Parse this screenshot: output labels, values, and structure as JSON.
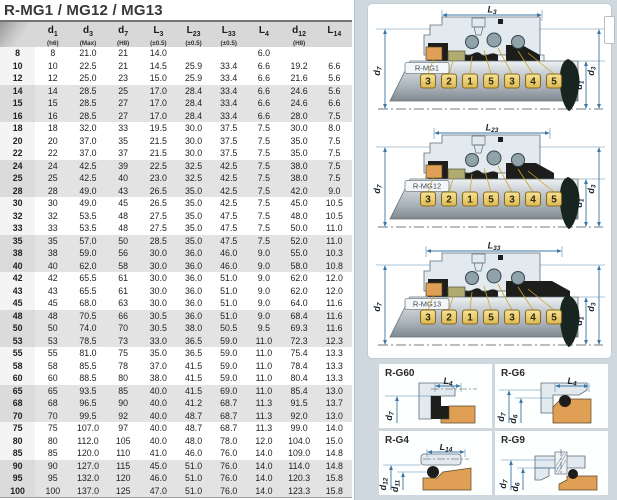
{
  "title": "R-MG1 / MG12 / MG13",
  "table": {
    "headers": [
      {
        "main": "",
        "sub": "",
        "note": ""
      },
      {
        "main": "d",
        "sub": "1",
        "note": "(h6)"
      },
      {
        "main": "d",
        "sub": "3",
        "note": "(Max)"
      },
      {
        "main": "d",
        "sub": "7",
        "note": "(H8)"
      },
      {
        "main": "L",
        "sub": "3",
        "note": "(±0.5)"
      },
      {
        "main": "L",
        "sub": "23",
        "note": "(±0.5)"
      },
      {
        "main": "L",
        "sub": "33",
        "note": "(±0.5)"
      },
      {
        "main": "L",
        "sub": "4",
        "note": ""
      },
      {
        "main": "d",
        "sub": "12",
        "note": "(H8)"
      },
      {
        "main": "L",
        "sub": "14",
        "note": ""
      }
    ],
    "rows": [
      [
        "8",
        "8",
        "21.0",
        "21",
        "14.0",
        "",
        "",
        "6.0",
        "",
        ""
      ],
      [
        "10",
        "10",
        "22.5",
        "21",
        "14.5",
        "25.9",
        "33.4",
        "6.6",
        "19.2",
        "6.6"
      ],
      [
        "12",
        "12",
        "25.0",
        "23",
        "15.0",
        "25.9",
        "33.4",
        "6.6",
        "21.6",
        "5.6"
      ],
      [
        "14",
        "14",
        "28.5",
        "25",
        "17.0",
        "28.4",
        "33.4",
        "6.6",
        "24.6",
        "5.6"
      ],
      [
        "15",
        "15",
        "28.5",
        "27",
        "17.0",
        "28.4",
        "33.4",
        "6.6",
        "24.6",
        "6.6"
      ],
      [
        "16",
        "16",
        "28.5",
        "27",
        "17.0",
        "28.4",
        "33.4",
        "6.6",
        "28.0",
        "7.5"
      ],
      [
        "18",
        "18",
        "32.0",
        "33",
        "19.5",
        "30.0",
        "37.5",
        "7.5",
        "30.0",
        "8.0"
      ],
      [
        "20",
        "20",
        "37.0",
        "35",
        "21.5",
        "30.0",
        "37.5",
        "7.5",
        "35.0",
        "7.5"
      ],
      [
        "22",
        "22",
        "37.0",
        "37",
        "21.5",
        "30.0",
        "37.5",
        "7.5",
        "35.0",
        "7.5"
      ],
      [
        "24",
        "24",
        "42.5",
        "39",
        "22.5",
        "32.5",
        "42.5",
        "7.5",
        "38.0",
        "7.5"
      ],
      [
        "25",
        "25",
        "42.5",
        "40",
        "23.0",
        "32.5",
        "42.5",
        "7.5",
        "38.0",
        "7.5"
      ],
      [
        "28",
        "28",
        "49.0",
        "43",
        "26.5",
        "35.0",
        "42.5",
        "7.5",
        "42.0",
        "9.0"
      ],
      [
        "30",
        "30",
        "49.0",
        "45",
        "26.5",
        "35.0",
        "42.5",
        "7.5",
        "45.0",
        "10.5"
      ],
      [
        "32",
        "32",
        "53.5",
        "48",
        "27.5",
        "35.0",
        "47.5",
        "7.5",
        "48.0",
        "10.5"
      ],
      [
        "33",
        "33",
        "53.5",
        "48",
        "27.5",
        "35.0",
        "47.5",
        "7.5",
        "50.0",
        "11.0"
      ],
      [
        "35",
        "35",
        "57.0",
        "50",
        "28.5",
        "35.0",
        "47.5",
        "7.5",
        "52.0",
        "11.0"
      ],
      [
        "38",
        "38",
        "59.0",
        "56",
        "30.0",
        "36.0",
        "46.0",
        "9.0",
        "55.0",
        "10.3"
      ],
      [
        "40",
        "40",
        "62.0",
        "58",
        "30.0",
        "36.0",
        "46.0",
        "9.0",
        "58.0",
        "10.8"
      ],
      [
        "42",
        "42",
        "65.5",
        "61",
        "30.0",
        "36.0",
        "51.0",
        "9.0",
        "62.0",
        "12.0"
      ],
      [
        "43",
        "43",
        "65.5",
        "61",
        "30.0",
        "36.0",
        "51.0",
        "9.0",
        "62.0",
        "12.0"
      ],
      [
        "45",
        "45",
        "68.0",
        "63",
        "30.0",
        "36.0",
        "51.0",
        "9.0",
        "64.0",
        "11.6"
      ],
      [
        "48",
        "48",
        "70.5",
        "66",
        "30.5",
        "36.0",
        "51.0",
        "9.0",
        "68.4",
        "11.6"
      ],
      [
        "50",
        "50",
        "74.0",
        "70",
        "30.5",
        "38.0",
        "50.5",
        "9.5",
        "69.3",
        "11.6"
      ],
      [
        "53",
        "53",
        "78.5",
        "73",
        "33.0",
        "36.5",
        "59.0",
        "11.0",
        "72.3",
        "12.3"
      ],
      [
        "55",
        "55",
        "81.0",
        "75",
        "35.0",
        "36.5",
        "59.0",
        "11.0",
        "75.4",
        "13.3"
      ],
      [
        "58",
        "58",
        "85.5",
        "78",
        "37.0",
        "41.5",
        "59.0",
        "11.0",
        "78.4",
        "13.3"
      ],
      [
        "60",
        "60",
        "88.5",
        "80",
        "38.0",
        "41.5",
        "59.0",
        "11.0",
        "80.4",
        "13.3"
      ],
      [
        "65",
        "65",
        "93.5",
        "85",
        "40.0",
        "41.5",
        "69.0",
        "11.0",
        "85.4",
        "13.0"
      ],
      [
        "68",
        "68",
        "96.5",
        "90",
        "40.0",
        "41.2",
        "68.7",
        "11.3",
        "91.5",
        "13.7"
      ],
      [
        "70",
        "70",
        "99.5",
        "92",
        "40.0",
        "48.7",
        "68.7",
        "11.3",
        "92.0",
        "13.0"
      ],
      [
        "75",
        "75",
        "107.0",
        "97",
        "40.0",
        "48.7",
        "68.7",
        "11.3",
        "99.0",
        "14.0"
      ],
      [
        "80",
        "80",
        "112.0",
        "105",
        "40.0",
        "48.0",
        "78.0",
        "12.0",
        "104.0",
        "15.0"
      ],
      [
        "85",
        "85",
        "120.0",
        "110",
        "41.0",
        "46.0",
        "76.0",
        "14.0",
        "109.0",
        "14.8"
      ],
      [
        "90",
        "90",
        "127.0",
        "115",
        "45.0",
        "51.0",
        "76.0",
        "14.0",
        "114.0",
        "14.8"
      ],
      [
        "95",
        "95",
        "132.0",
        "120",
        "46.0",
        "51.0",
        "76.0",
        "14.0",
        "120.3",
        "15.8"
      ],
      [
        "100",
        "100",
        "137.0",
        "125",
        "47.0",
        "51.0",
        "76.0",
        "14.0",
        "123.3",
        "15.8"
      ]
    ]
  },
  "parts_sequence": [
    "3",
    "2",
    "1",
    "5",
    "3",
    "4",
    "5"
  ],
  "diagrams": [
    {
      "label": "R-MG1",
      "top_dim": "L3",
      "left_dim": "d7",
      "right_dims": [
        "d1",
        "d3"
      ]
    },
    {
      "label": "R-MG12",
      "top_dim": "L23",
      "left_dim": "d7",
      "right_dims": [
        "d1",
        "d3"
      ]
    },
    {
      "label": "R-MG13",
      "top_dim": "L33",
      "left_dim": "d7",
      "right_dims": [
        "d1",
        "d3"
      ]
    }
  ],
  "cards": [
    {
      "label": "R-G60",
      "top_dim": "L4",
      "left_dims": [
        "d7"
      ],
      "variant": "g60"
    },
    {
      "label": "R-G6",
      "top_dim": "L4",
      "left_dims": [
        "d7",
        "d6"
      ],
      "variant": "g6"
    },
    {
      "label": "R-G4",
      "top_dim": "L14",
      "left_dims": [
        "d12",
        "d11"
      ],
      "variant": "g4"
    },
    {
      "label": "R-G9",
      "top_dim": "",
      "left_dims": [
        "d7",
        "d6"
      ],
      "variant": "g9"
    }
  ],
  "colors": {
    "dim": "#3a76a6",
    "dark": "#1d1d1b",
    "drop": "#17241f",
    "orange": "#dfa055",
    "olive": "#afab72",
    "steel": "#90a2aa",
    "housing": "#e2e9ef",
    "housing2": "#eef3f6",
    "leader": "#c9a42e",
    "tag1": "#f6e395",
    "tag2": "#dcb952",
    "tagBorder": "#8a6a22",
    "line": "#5d6d79",
    "header_bg": "#d8d8d8",
    "stripe": "#e3e3e3",
    "panel_bg": "#cfd8df",
    "centerline": "#46525c"
  }
}
